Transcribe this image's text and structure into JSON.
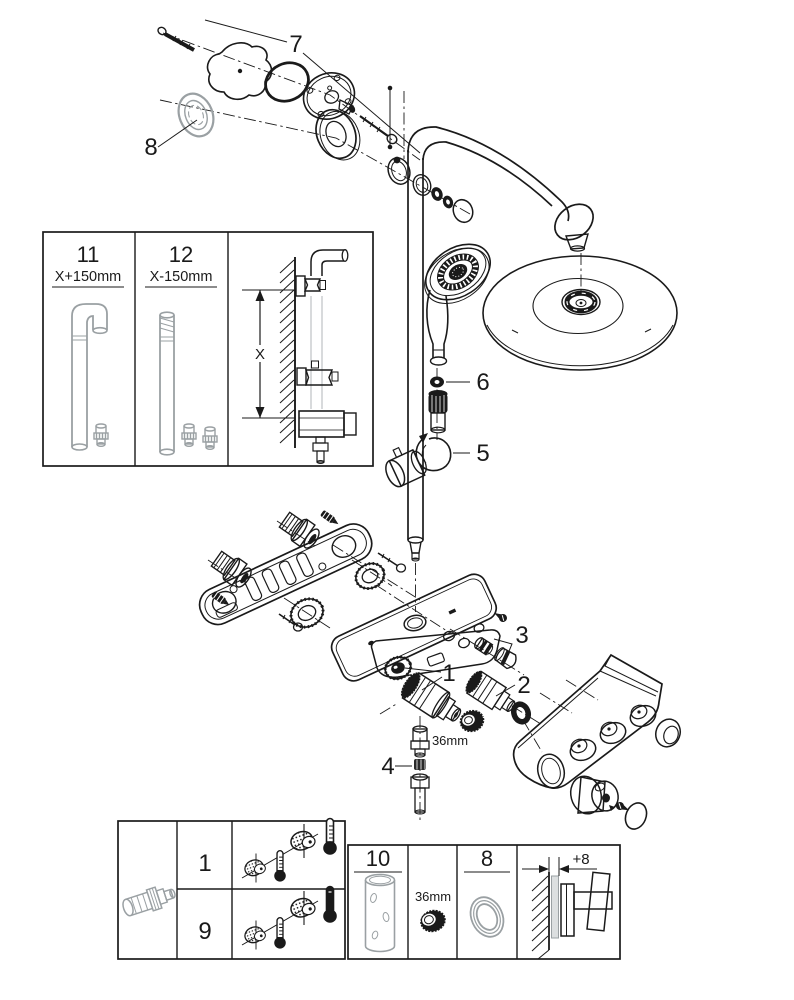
{
  "palette": {
    "ink": "#1a1a1a",
    "muted_gray": "#9aa0a3",
    "light_gray": "#c3c7c9",
    "background": "#ffffff"
  },
  "diagram": {
    "callouts": {
      "wall_union_kit": "7",
      "escutcheon_ring": "8",
      "handshower_seal": "6",
      "handshower_holder": "5",
      "check_valve": "3",
      "cartridge_left": "1",
      "cartridge_right": "2",
      "outlet_connector": "4",
      "nut_size": "36mm"
    },
    "pipe_inset": {
      "left_part": "11",
      "left_dim": "X+150mm",
      "right_part": "12",
      "right_dim": "X-150mm",
      "dimension": "X"
    },
    "parts_box": {
      "row_top": "1",
      "row_bottom": "9"
    },
    "service_box": {
      "tube_part": "10",
      "nut_size": "36mm",
      "ring_part": "8",
      "offset": "+8"
    }
  }
}
